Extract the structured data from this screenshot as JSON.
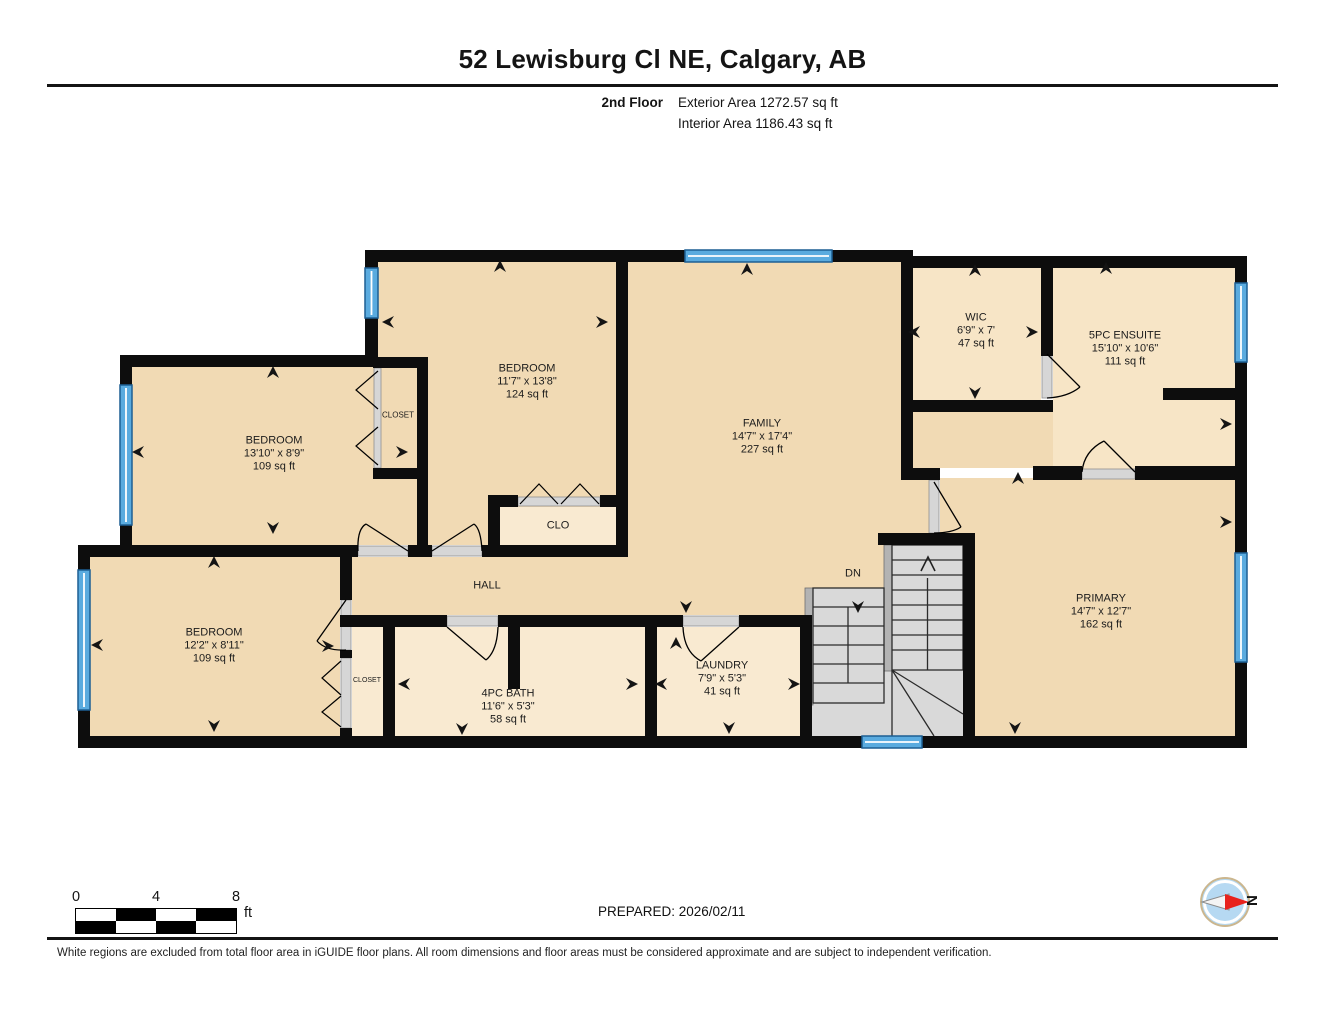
{
  "header": {
    "title": "52 Lewisburg Cl NE, Calgary, AB",
    "floor_label": "2nd Floor",
    "exterior_area": "Exterior Area 1272.57 sq ft",
    "interior_area": "Interior Area 1186.43 sq ft"
  },
  "rooms": {
    "bedroom_top_left": {
      "name": "BEDROOM",
      "dims": "13'10\" x 8'9\"",
      "area": "109 sq ft"
    },
    "bedroom_top_middle": {
      "name": "BEDROOM",
      "dims": "11'7\" x 13'8\"",
      "area": "124 sq ft"
    },
    "bedroom_bottom_left": {
      "name": "BEDROOM",
      "dims": "12'2\" x 8'11\"",
      "area": "109 sq ft"
    },
    "family": {
      "name": "FAMILY",
      "dims": "14'7\" x 17'4\"",
      "area": "227 sq ft"
    },
    "wic": {
      "name": "WIC",
      "dims": "6'9\" x 7'",
      "area": "47 sq ft"
    },
    "ensuite": {
      "name": "5PC ENSUITE",
      "dims": "15'10\" x 10'6\"",
      "area": "111 sq ft"
    },
    "primary": {
      "name": "PRIMARY",
      "dims": "14'7\" x 12'7\"",
      "area": "162 sq ft"
    },
    "bath": {
      "name": "4PC BATH",
      "dims": "11'6\" x 5'3\"",
      "area": "58 sq ft"
    },
    "laundry": {
      "name": "LAUNDRY",
      "dims": "7'9\" x 5'3\"",
      "area": "41 sq ft"
    },
    "hall": {
      "name": "HALL"
    },
    "clo": {
      "name": "CLO"
    },
    "closet_top": {
      "name": "CLOSET"
    },
    "closet_bottom": {
      "name": "CLOSET"
    },
    "stairs": {
      "direction": "DN"
    }
  },
  "footer": {
    "scale_ticks": [
      "0",
      "4",
      "8"
    ],
    "scale_unit": "ft",
    "prepared": "PREPARED: 2026/02/11",
    "compass_north": "N",
    "disclaimer": "White regions are excluded from total floor area in iGUIDE floor plans. All room dimensions and floor areas must be considered approximate and are subject to independent verification."
  },
  "colors": {
    "wall": "#0d0d0d",
    "room_fill": "#f1dab4",
    "closet_fill": "#f9ead1",
    "window_blue": "#5aabdf",
    "stairs_gray": "#d9d9d9",
    "compass_red": "#e8221c"
  }
}
